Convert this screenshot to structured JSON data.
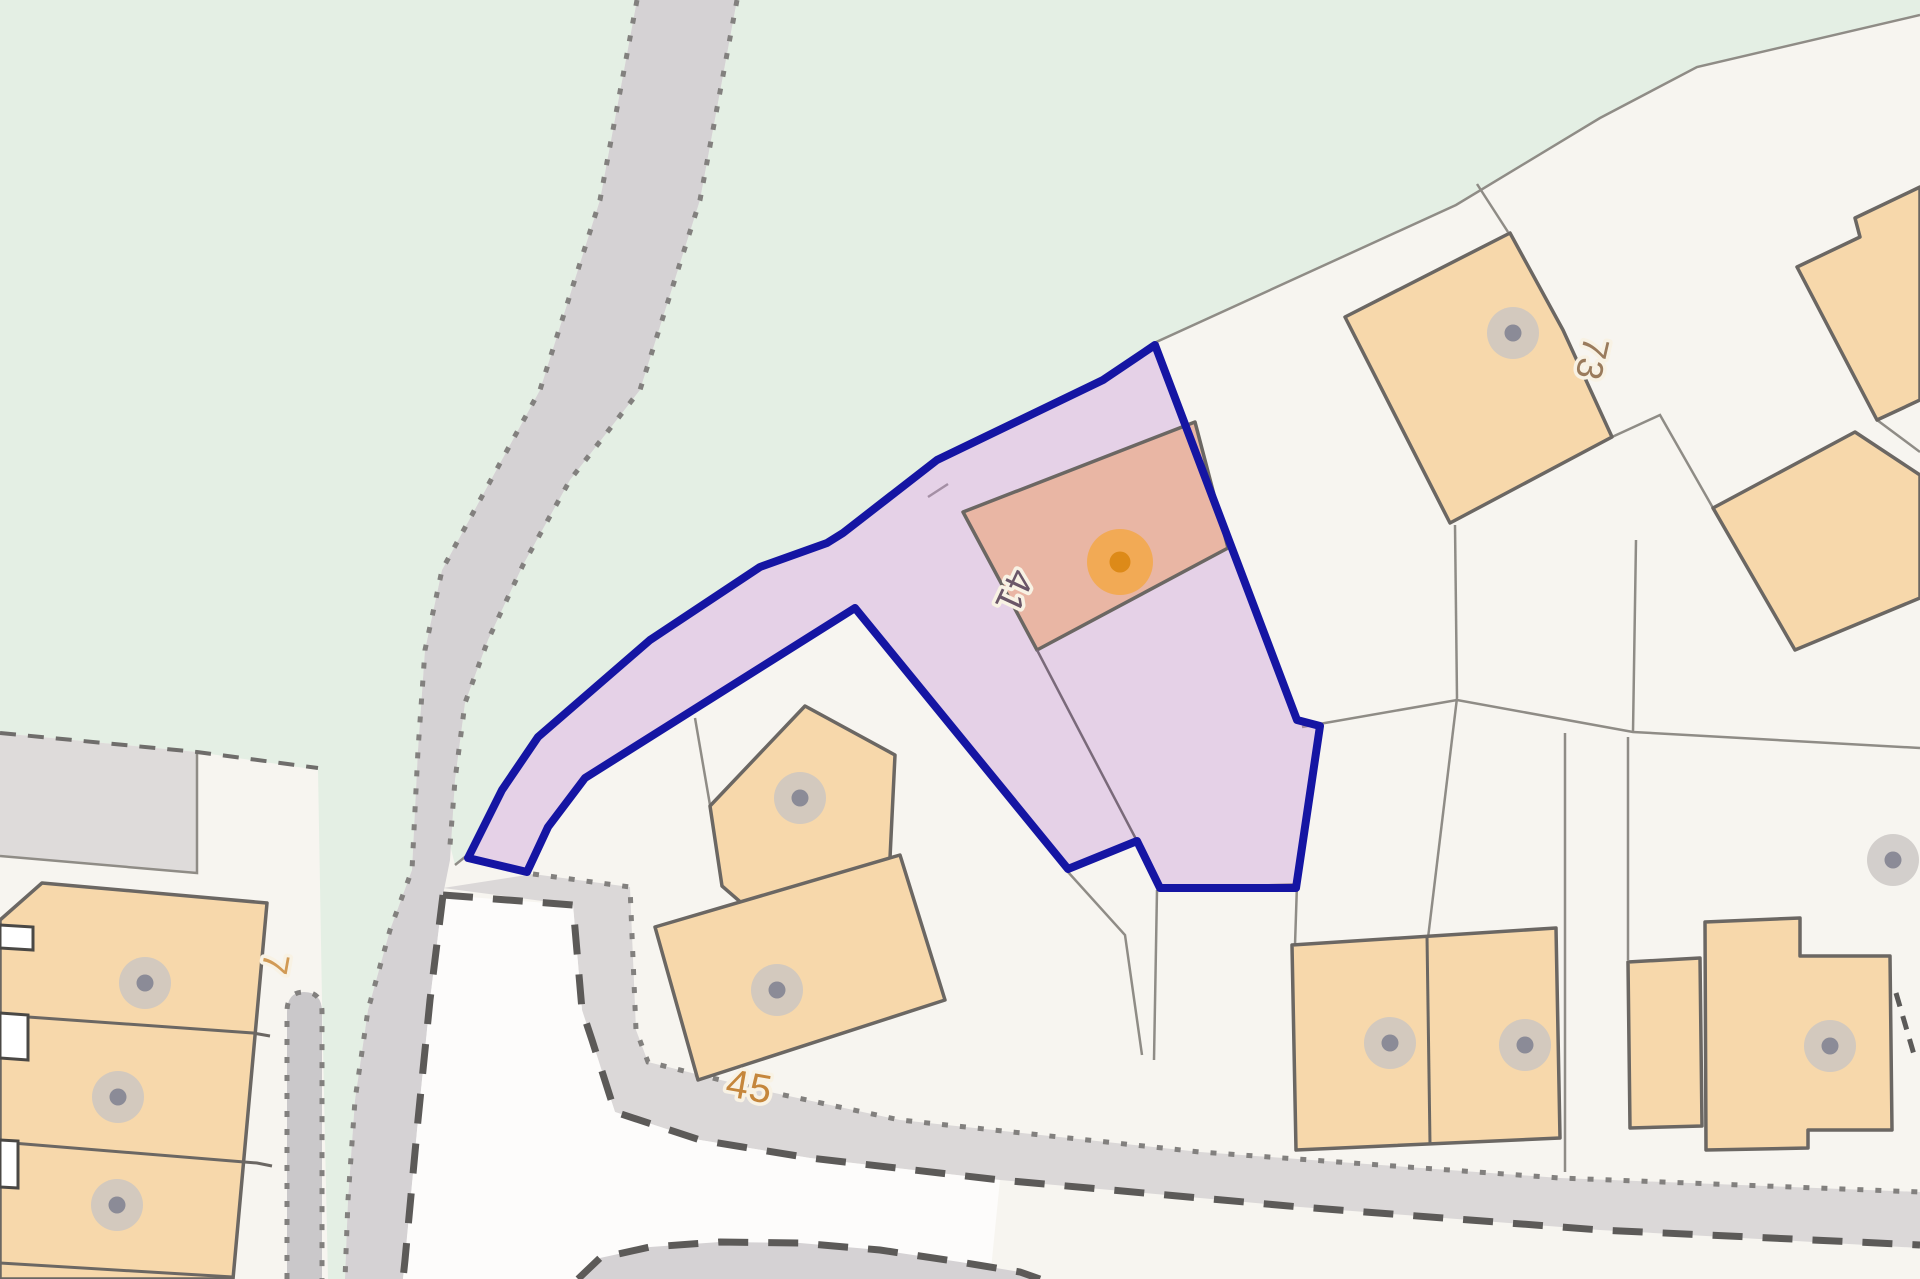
{
  "map": {
    "kind": "property-title-plan",
    "labels": {
      "plot_41": "41",
      "plot_73": "73",
      "plot_45": "45",
      "plot_7": "7"
    },
    "icons": {
      "building_marker": "gray-dot-icon",
      "selected_building_marker": "orange-dot-icon"
    },
    "colors": {
      "background": "#f7f5f0",
      "green_space": "#e4efe4",
      "road": "#d5d2d4",
      "road_bottom": "#dbd8d8",
      "footpath": "#cac8ca",
      "forecourt": "#fdfcfb",
      "gray_parcel": "#dedbda",
      "building": "#f7d8ab",
      "selected_building": "#e9b6a4",
      "selected_parcel_fill": "rgba(200,150,215,0.38)",
      "selected_parcel_border": "#1515a3",
      "marker_gray_outer": "#c9c5c3",
      "marker_gray_inner": "#8b8b97",
      "marker_orange_outer": "#f3a94d",
      "marker_orange_inner": "#dd8a18",
      "label_41_color": "#6a5668",
      "label_73_color": "#9a7b5c",
      "label_45_color": "#c5863b",
      "label_7_color": "#d19a55"
    }
  }
}
